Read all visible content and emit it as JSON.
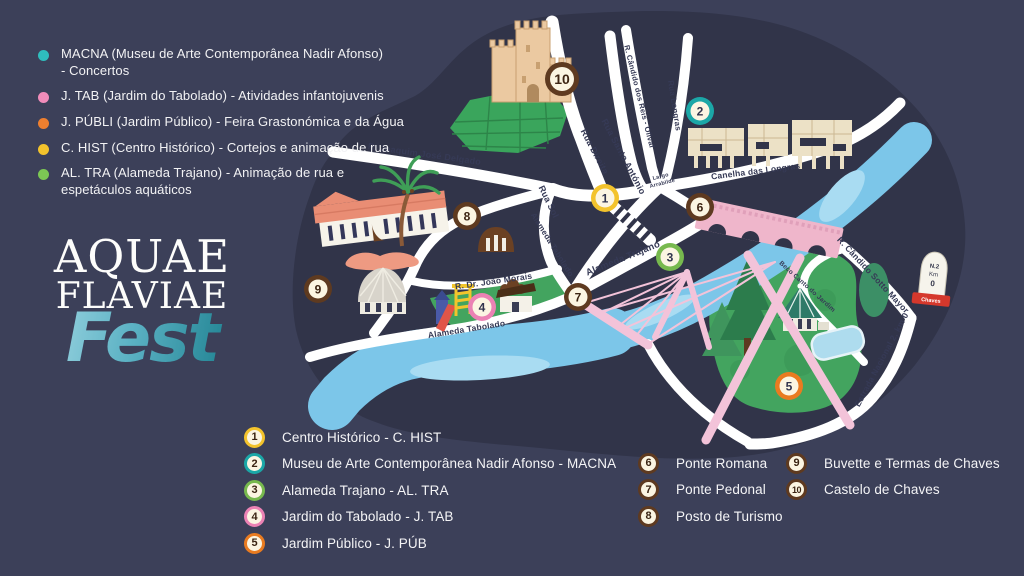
{
  "palette": {
    "background": "#3c4059",
    "map_blob": "#313449",
    "road": "#ffffff",
    "street_label": "#363a56",
    "river": "#7cc6e9",
    "river_light": "#a9dcf2",
    "park_green": "#43a45f",
    "pine_dark": "#2c7c4c",
    "castle_tan": "#ebc9a1",
    "museum_cream": "#ece1c6",
    "bridge_pink": "#f3c3d9",
    "roman_pink": "#efb6cb",
    "salmon": "#ee9a82",
    "dome_gray": "#d8d4cb",
    "brown": "#5e3a20",
    "marker_inner": "#fbf5e2",
    "yellow": "#f3c32c",
    "teal": "#1ba7a7",
    "green": "#77b94e",
    "pink": "#eb82b4",
    "orange": "#e97b20"
  },
  "logo": {
    "line1": "AQUAE",
    "line2": "FLAVIAE",
    "line3": "Fest"
  },
  "activities_legend": {
    "items": [
      {
        "color": "#2fbdbd",
        "text": "MACNA (Museu de Arte Contemporânea Nadir Afonso)\n- Concertos"
      },
      {
        "color": "#f18cba",
        "text": "J. TAB (Jardim do Tabolado) - Atividades infantojuvenis"
      },
      {
        "color": "#ee7f2f",
        "text": "J. PÚBLI (Jardim Público) - Feira Grastonómica e da Água"
      },
      {
        "color": "#f3c32c",
        "text": "C. HIST (Centro Histórico) - Cortejos e animação de rua"
      },
      {
        "color": "#7cc854",
        "text": "AL. TRA (Alameda Trajano) - Animação de rua e\nespetáculos aquáticos"
      }
    ]
  },
  "locations_legend": {
    "columns": [
      {
        "items": [
          {
            "n": "1",
            "color": "#f3c32c",
            "label": "Centro Histórico - C. HIST"
          },
          {
            "n": "2",
            "color": "#1ba7a7",
            "label": "Museu de Arte Contemporânea Nadir Afonso - MACNA"
          },
          {
            "n": "3",
            "color": "#77b94e",
            "label": "Alameda Trajano - AL. TRA"
          },
          {
            "n": "4",
            "color": "#eb82b4",
            "label": "Jardim do Tabolado - J. TAB"
          },
          {
            "n": "5",
            "color": "#e97b20",
            "label": "Jardim Público - J. PÚB"
          }
        ]
      },
      {
        "items": [
          {
            "n": "6",
            "color": "#5e3a20",
            "label": "Ponte Romana"
          },
          {
            "n": "7",
            "color": "#5e3a20",
            "label": "Ponte Pedonal"
          },
          {
            "n": "8",
            "color": "#5e3a20",
            "label": "Posto de Turismo"
          }
        ]
      },
      {
        "items": [
          {
            "n": "9",
            "color": "#5e3a20",
            "label": "Buvette e Termas de Chaves"
          },
          {
            "n": "10",
            "color": "#5e3a20",
            "label": "Castelo de Chaves"
          }
        ]
      }
    ]
  },
  "map": {
    "markers": [
      {
        "n": "1",
        "x": 605,
        "y": 198,
        "color": "#f3c32c"
      },
      {
        "n": "2",
        "x": 700,
        "y": 111,
        "color": "#1ba7a7"
      },
      {
        "n": "3",
        "x": 670,
        "y": 257,
        "color": "#77b94e"
      },
      {
        "n": "4",
        "x": 482,
        "y": 307,
        "color": "#eb82b4"
      },
      {
        "n": "5",
        "x": 789,
        "y": 386,
        "color": "#e97b20"
      },
      {
        "n": "6",
        "x": 700,
        "y": 207,
        "color": "#5e3a20"
      },
      {
        "n": "7",
        "x": 578,
        "y": 297,
        "color": "#5e3a20"
      },
      {
        "n": "8",
        "x": 467,
        "y": 216,
        "color": "#5e3a20"
      },
      {
        "n": "9",
        "x": 318,
        "y": 289,
        "color": "#5e3a20"
      },
      {
        "n": "10",
        "x": 562,
        "y": 79,
        "color": "#5e3a20",
        "big": true
      }
    ],
    "street_labels": [
      {
        "text": "R. Joaquim José Delgado",
        "x": 424,
        "y": 157,
        "rot": 8,
        "size": 9
      },
      {
        "text": "Rua Direita",
        "x": 592,
        "y": 153,
        "rot": 62,
        "size": 9
      },
      {
        "text": "Rua Santo António",
        "x": 621,
        "y": 158,
        "rot": 62,
        "size": 9
      },
      {
        "text": "R. Cândido dos Reis - Olival",
        "x": 637,
        "y": 97,
        "rot": 76,
        "size": 7.5
      },
      {
        "text": "Rua Longras",
        "x": 672,
        "y": 106,
        "rot": 81,
        "size": 8
      },
      {
        "text": "Largo",
        "x": 661,
        "y": 178,
        "rot": -14,
        "size": 5.5,
        "line2": "Arrabilde"
      },
      {
        "text": "Canelha das Longras",
        "x": 756,
        "y": 174,
        "rot": -7,
        "size": 8.5
      },
      {
        "text": "Rua Sol",
        "x": 546,
        "y": 203,
        "rot": 64,
        "size": 9
      },
      {
        "text": "Alameda Tabolado",
        "x": 550,
        "y": 246,
        "rot": 58,
        "size": 8
      },
      {
        "text": "Alameda Trajano",
        "x": 624,
        "y": 261,
        "rot": -22,
        "size": 9.5
      },
      {
        "text": "R. Dr. João Morais",
        "x": 494,
        "y": 284,
        "rot": -8,
        "size": 8.5
      },
      {
        "text": "Alameda Tabolado",
        "x": 467,
        "y": 332,
        "rot": -9,
        "size": 8.5
      },
      {
        "text": "R. Cândido Sotto Mayor",
        "x": 871,
        "y": 277,
        "rot": 47,
        "size": 8.5
      },
      {
        "text": "Beco Canto do Jardim",
        "x": 806,
        "y": 288,
        "rot": 42,
        "size": 6.5
      },
      {
        "text": "Estrada Nacional 2, km 0",
        "x": 884,
        "y": 361,
        "rot": -62,
        "size": 8.5
      }
    ],
    "milestone": {
      "line1": "N.2",
      "line2": "Km",
      "line3": "0",
      "base": "Chaves"
    }
  }
}
